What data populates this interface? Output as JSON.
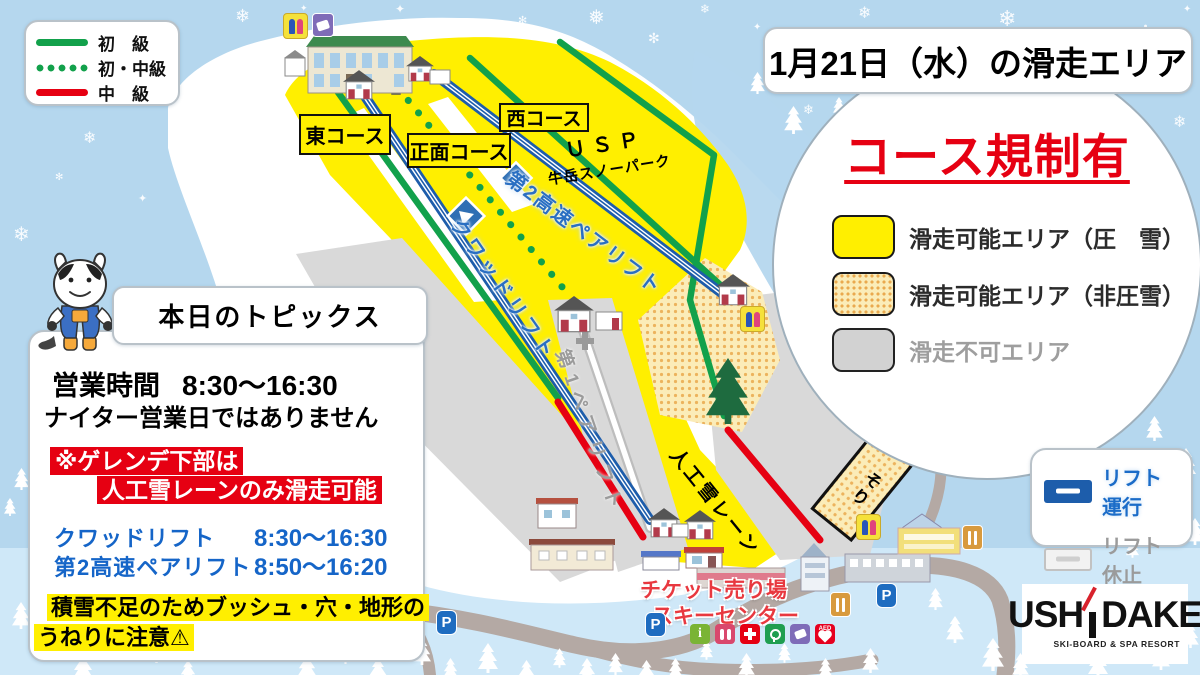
{
  "header": {
    "title": "1月21日（水）の滑走エリア"
  },
  "difficulty_legend": {
    "items": [
      {
        "label": "初　級",
        "line": "green-solid"
      },
      {
        "label": "初・中級",
        "line": "green-dotted"
      },
      {
        "label": "中　級",
        "line": "red-solid"
      }
    ]
  },
  "restriction": {
    "heading": "コース規制有",
    "items": [
      {
        "label": "滑走可能エリア（圧　雪）",
        "swatch": "yellow"
      },
      {
        "label": "滑走可能エリア（非圧雪）",
        "swatch": "dotted-tan"
      },
      {
        "label": "滑走不可エリア",
        "swatch": "gray"
      }
    ]
  },
  "topics": {
    "heading": "本日のトピックス",
    "hours_label": "営業時間",
    "hours_value": "8:30～16:30",
    "night_notice": "ナイター営業日ではありません",
    "warning_line1": "※ゲレンデ下部は",
    "warning_line2": "人工雪レーンのみ滑走可能",
    "lifts": [
      {
        "name": "クワッドリフト",
        "hours": "8:30～16:30"
      },
      {
        "name": "第2高速ペアリフト",
        "hours": "8:50～16:20"
      }
    ],
    "caution_line1": "積雪不足のためブッシュ・穴・地形の",
    "caution_line2": "うねりに注意⚠"
  },
  "lift_legend": {
    "running": "リフト運行",
    "stopped": "リフト休止"
  },
  "logo": {
    "part1": "USH",
    "part2": "DAKE",
    "subtitle": "SKI-BOARD & SPA RESORT"
  },
  "map": {
    "course_labels": [
      {
        "label": "東コース"
      },
      {
        "label": "正面コース"
      },
      {
        "label": "西コース"
      }
    ],
    "usp_line1": "ＵＳＰ",
    "usp_line2": "牛岳スノーパーク",
    "lift_quad": "クワッドリフト",
    "lift_pair2": "第2高速ペアリフト",
    "lift_pair1": "第1ペアリフト",
    "snow_lane": "人工雪レーン",
    "sled_area": "そり",
    "ticket_line1": "チケット売り場",
    "ticket_line2": "スキーセンター",
    "parking": "P",
    "info_letter": "i",
    "aed_label": "AED"
  },
  "colors": {
    "sky": "#b5d7ee",
    "lower_snow": "#cfe8f8",
    "open_groomed": "#ffef00",
    "open_ungroomed": "#fbecb8",
    "closed_area": "#d9d9d9",
    "beginner_green": "#12a14b",
    "intermediate_red": "#e60012",
    "lift_running_blue": "#1d5dab",
    "lift_stopped_gray": "#c2c2c2",
    "restriction_red": "#e60012",
    "road": "#b4a9a4"
  }
}
